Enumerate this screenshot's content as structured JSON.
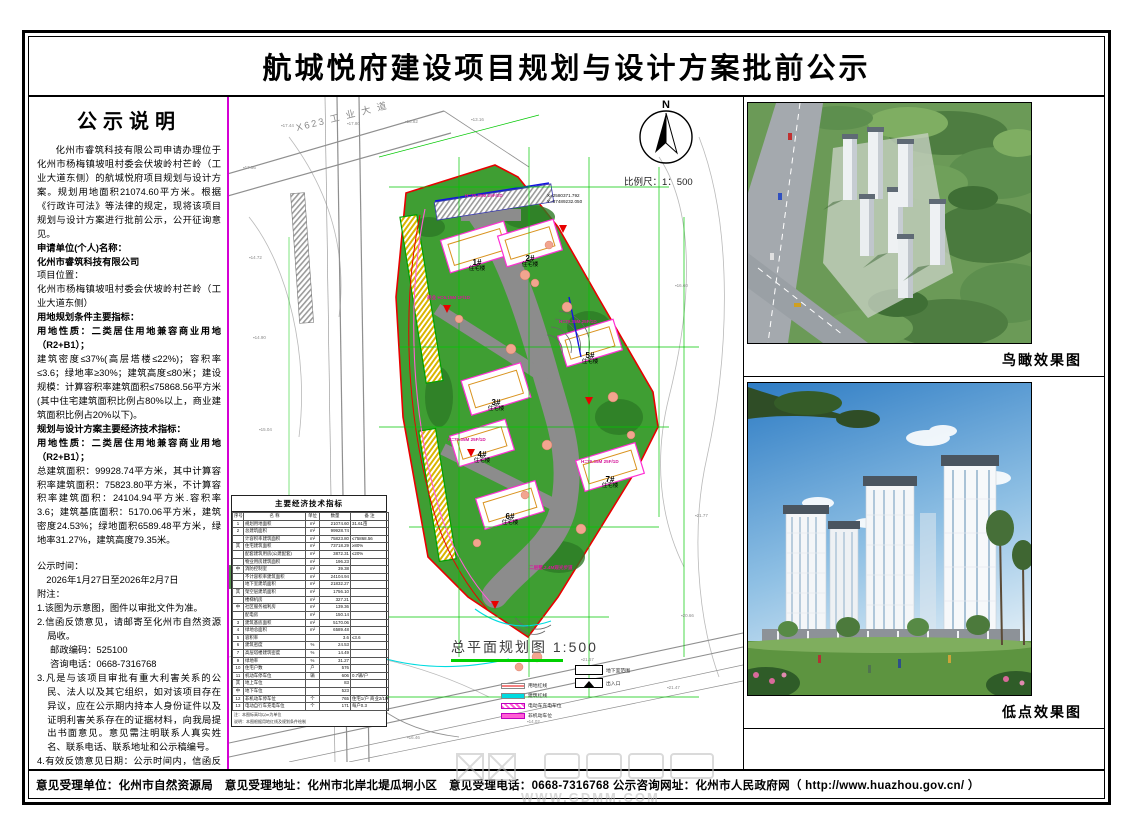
{
  "title": "航城悦府建设项目规划与设计方案批前公示",
  "notice": {
    "heading": "公示说明",
    "paragraphs": [
      {
        "text": "化州市睿筑科技有限公司申请办理位于化州市杨梅镇坡咀村委会伏坡岭村芒岭（工业大道东侧）的航城悦府项目规划与设计方案。规划用地面积21074.60平方米。根据《行政许可法》等法律的规定，现将该项目规划与设计方案进行批前公示，公开征询意见。"
      },
      {
        "text": "申请单位(个人)名称："
      },
      {
        "text": "化州市睿筑科技有限公司"
      },
      {
        "text": "项目位置："
      },
      {
        "text": "化州市杨梅镇坡咀村委会伏坡岭村芒岭（工业大道东侧）"
      },
      {
        "text": "用地规划条件主要指标："
      },
      {
        "text": "用地性质：二类居住用地兼容商业用地（R2+B1）；"
      },
      {
        "text": "建筑密度≤37%(高层塔楼≤22%)；容积率≤3.6；绿地率≥30%；建筑高度≤80米；建设规模：计算容积率建筑面积≤75868.56平方米(其中住宅建筑面积比例占80%以上，商业建筑面积比例占20%以下)。"
      },
      {
        "text": "规划与设计方案主要经济技术指标："
      },
      {
        "text": "用地性质：二类居住用地兼容商业用地（R2+B1）；"
      },
      {
        "text": "总建筑面积：99928.74平方米，其中计算容积率建筑面积：75823.80平方米，不计算容积率建筑面积：24104.94平方米.容积率3.6；建筑基底面积：5170.06平方米，建筑密度24.53%；绿地面积6589.48平方米，绿地率31.27%，建筑高度79.35米。"
      },
      {
        "text": "公示时间："
      },
      {
        "text": "2026年1月27日至2026年2月7日"
      },
      {
        "text": "附注："
      },
      {
        "text": "1.该图为示意图，图件以审批文件为准。"
      },
      {
        "text": "2.信函反馈意见，请邮寄至化州市自然资源局收。"
      },
      {
        "text": "邮政编码：525100"
      },
      {
        "text": "咨询电话：0668-7316768"
      },
      {
        "text": "3.凡是与该项目审批有重大利害关系的公民、法人以及其它组织，如对该项目存在异议，应在公示期内持本人身份证件以及证明利害关系存在的证据材料，向我局提出书面意见。意见需注明联系人真实姓名、联系电话、联系地址和公示稿编号。"
      },
      {
        "text": "4.有效反馈意见日期：公示时间内，信函反馈意见邮戳日不应超过公示时间最后一天的24:00，逾期视为无效意见，不予采纳。"
      },
      {
        "text": "5.查询网址：http://www.huazhou.gov.cn/"
      }
    ]
  },
  "plan": {
    "road_label": "X623 工 业 大 道",
    "north_label": "N",
    "scale_label": "比例尺：1：500",
    "caption": "总平面规划图 1:500",
    "coord_label_x": "X=2580371.792",
    "coord_label_y": "Y=37489232.050",
    "buildings": [
      {
        "id": "1#",
        "type": "住宅楼",
        "x": 248,
        "y": 170
      },
      {
        "id": "2#",
        "type": "住宅楼",
        "x": 301,
        "y": 166
      },
      {
        "id": "3#",
        "type": "住宅楼",
        "x": 267,
        "y": 310
      },
      {
        "id": "4#",
        "type": "住宅楼",
        "x": 253,
        "y": 362
      },
      {
        "id": "5#",
        "type": "住宅楼",
        "x": 361,
        "y": 263
      },
      {
        "id": "6#",
        "type": "住宅楼",
        "x": 281,
        "y": 424
      },
      {
        "id": "7#",
        "type": "住宅楼",
        "x": 381,
        "y": 387
      }
    ],
    "spec_labels": [
      {
        "x": 236,
        "y": 96,
        "text": "H=79.35M 25F/2D"
      },
      {
        "x": 198,
        "y": 198,
        "text": "商业 H=6.15M 1F/1D"
      },
      {
        "x": 330,
        "y": 222,
        "text": "H=79.35M 25F/1D"
      },
      {
        "x": 219,
        "y": 340,
        "text": "H=79.35M 25F/1D"
      },
      {
        "x": 352,
        "y": 362,
        "text": "H=79.35M 25F/1D"
      },
      {
        "x": 300,
        "y": 468,
        "text": "二层墅.2.4M观光步道"
      }
    ],
    "elevations": [
      {
        "x": 52,
        "y": 26,
        "v": "17.44"
      },
      {
        "x": 118,
        "y": 24,
        "v": "17.80"
      },
      {
        "x": 176,
        "y": 22,
        "v": "16.82"
      },
      {
        "x": 242,
        "y": 20,
        "v": "13.16"
      },
      {
        "x": 14,
        "y": 68,
        "v": "17.56"
      },
      {
        "x": 20,
        "y": 158,
        "v": "14.72"
      },
      {
        "x": 24,
        "y": 238,
        "v": "14.90"
      },
      {
        "x": 30,
        "y": 330,
        "v": "15.04"
      },
      {
        "x": 12,
        "y": 408,
        "v": "14.58"
      },
      {
        "x": 446,
        "y": 186,
        "v": "16.60"
      },
      {
        "x": 466,
        "y": 416,
        "v": "21.77"
      },
      {
        "x": 452,
        "y": 516,
        "v": "20.66"
      },
      {
        "x": 438,
        "y": 588,
        "v": "21.47"
      },
      {
        "x": 178,
        "y": 638,
        "v": "16.46"
      },
      {
        "x": 298,
        "y": 622,
        "v": "14.02"
      },
      {
        "x": 352,
        "y": 560,
        "v": "21.67"
      }
    ],
    "legend": [
      {
        "label": "用地红线"
      },
      {
        "label": "建筑红线"
      },
      {
        "label": "电动车充电车位"
      },
      {
        "label": "非机动车位"
      },
      {
        "label": "地下室范围"
      },
      {
        "label": "出入口"
      }
    ],
    "table": {
      "title": "主要经济技术指标",
      "headers": [
        "序号",
        "名  称",
        "单位",
        "数量",
        "备  注"
      ],
      "rows": [
        {
          "no": "1",
          "name": "规划用地面积",
          "unit": "m²",
          "qty": "21074.60",
          "note": "31.61亩"
        },
        {
          "no": "2",
          "name": "总建筑面积",
          "unit": "m²",
          "qty": "99928.74",
          "note": ""
        },
        {
          "no": "",
          "name": "计容积率建筑面积",
          "unit": "m²",
          "qty": "75823.80",
          "note": "≤75868.56"
        },
        {
          "no": "其",
          "name": "住宅建筑面积",
          "unit": "m²",
          "qty": "73718.29",
          "note": "≥80%"
        },
        {
          "no": "",
          "name": "配套建筑用房(公建配套)",
          "unit": "m²",
          "qty": "3872.31",
          "note": "≤20%"
        },
        {
          "no": "",
          "name": "物业用房建筑面积",
          "unit": "m²",
          "qty": "196.23",
          "note": ""
        },
        {
          "no": "中",
          "name": "消防控制室",
          "unit": "m²",
          "qty": "39.38",
          "note": ""
        },
        {
          "no": "",
          "name": "不计容积率建筑面积",
          "unit": "m²",
          "qty": "24104.94",
          "note": ""
        },
        {
          "no": "",
          "name": "地下室建筑面积",
          "unit": "m²",
          "qty": "21832.27",
          "note": ""
        },
        {
          "no": "其",
          "name": "架空层建筑面积",
          "unit": "m²",
          "qty": "1756.10",
          "note": ""
        },
        {
          "no": "",
          "name": "楼梯机房",
          "unit": "m²",
          "qty": "327.21",
          "note": ""
        },
        {
          "no": "中",
          "name": "社区服务福利房",
          "unit": "m²",
          "qty": "139.36",
          "note": ""
        },
        {
          "no": "",
          "name": "配电房",
          "unit": "m²",
          "qty": "150.14",
          "note": ""
        },
        {
          "no": "3",
          "name": "建筑基底面积",
          "unit": "m²",
          "qty": "5170.06",
          "note": ""
        },
        {
          "no": "4",
          "name": "绿地总面积",
          "unit": "m²",
          "qty": "6589.48",
          "note": ""
        },
        {
          "no": "5",
          "name": "容积率",
          "unit": "",
          "qty": "3.6",
          "note": "≤3.6"
        },
        {
          "no": "6",
          "name": "建筑密度",
          "unit": "%",
          "qty": "24.53",
          "note": ""
        },
        {
          "no": "7",
          "name": "高层塔楼建筑密度",
          "unit": "%",
          "qty": "14.49",
          "note": ""
        },
        {
          "no": "9",
          "name": "绿地率",
          "unit": "%",
          "qty": "31.27",
          "note": ""
        },
        {
          "no": "10",
          "name": "住宅户数",
          "unit": "户",
          "qty": "576",
          "note": ""
        },
        {
          "no": "11",
          "name": "机动车停车位",
          "unit": "辆",
          "qty": "606",
          "note": "0.7辆/户"
        },
        {
          "no": "其",
          "name": "地上车位",
          "unit": "",
          "qty": "83",
          "note": ""
        },
        {
          "no": "中",
          "name": "地下车位",
          "unit": "",
          "qty": "523",
          "note": ""
        },
        {
          "no": "12",
          "name": "非机动车停车位",
          "unit": "个",
          "qty": "765",
          "note": "住宅1/户 商业2/100m²"
        },
        {
          "no": "13",
          "name": "电动自行车充电车位",
          "unit": "个",
          "qty": "171",
          "note": "每户0.3"
        }
      ],
      "notes": [
        "注：本图标高均以m为单位",
        "说明：本图根据用地红线及规划条件绘制"
      ]
    }
  },
  "renders": {
    "aerial_caption": "鸟瞰效果图",
    "street_caption": "低点效果图"
  },
  "footer": {
    "text": "意见受理单位：化州市自然资源局　意见受理地址：化州市北岸北堤瓜坰小区　意见受理电话：0668-7316768 公示咨询网址：化州市人民政府网（ http://www.huazhou.gov.cn/ ）"
  },
  "watermark": {
    "text": "WWW.GDMM.COM"
  },
  "colors": {
    "separator_magenta": "#d400d4",
    "dimension_green": "#00c800",
    "site_green": "#3f9e33",
    "red_line": "#e80000",
    "cyan_line": "#00dbe0",
    "road_gray": "#9a9a9a",
    "building_magenta": "#ff2fd4"
  }
}
